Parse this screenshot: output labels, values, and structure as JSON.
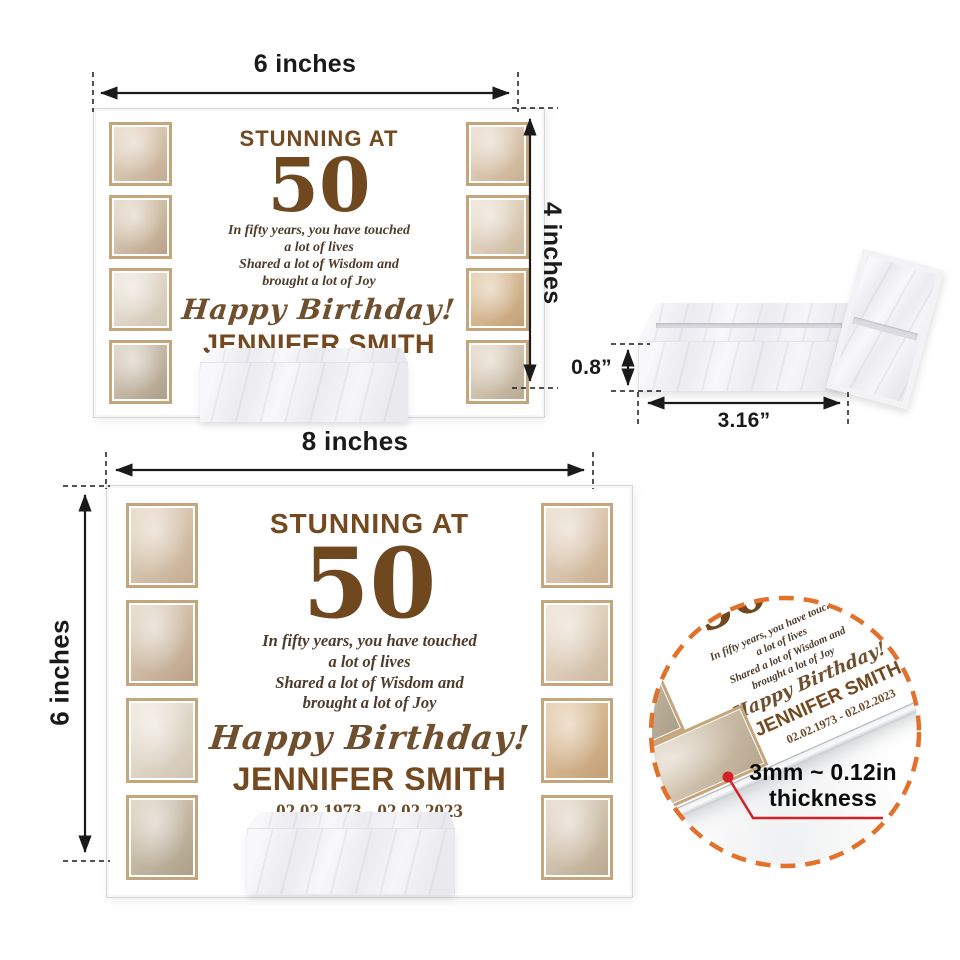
{
  "product_preview": {
    "plaque_text": {
      "title": "STUNNING AT",
      "age": "50",
      "message_lines": [
        "In fifty years, you have touched",
        "a lot of lives",
        "Shared a lot of Wisdom and",
        "brought a lot of Joy"
      ],
      "greeting": "Happy Birthday!",
      "name": "JENNIFER SMITH",
      "dates": "02.02.1973 - 02.02.2023"
    },
    "photos": [
      "three generations with flower bouquet",
      "grandmother and granddaughters looking at phone",
      "mother and children playing in living room",
      "grandmother and child taking selfie on couch",
      "three generations smiling close-up",
      "mother and daughter hugging",
      "family hands joined together",
      "family sitting on couch with phones"
    ],
    "photo_tones": [
      [
        "#e9dbc8",
        "#c2ab90"
      ],
      [
        "#e5d9c9",
        "#b9a084"
      ],
      [
        "#f0e9df",
        "#cfc3b0"
      ],
      [
        "#ddd3c4",
        "#ab9d86"
      ],
      [
        "#ecdfcf",
        "#c8ad8e"
      ],
      [
        "#efe4d6",
        "#cbb79e"
      ],
      [
        "#e7cfae",
        "#c29e74"
      ],
      [
        "#e8dccb",
        "#b7a78f"
      ]
    ],
    "colors": {
      "accent_brown": "#74491f",
      "number_brown": "#6f4820",
      "message_brown": "#4e3b2b",
      "frame_tan": "#c5a67c",
      "circle_orange": "#e2712c",
      "annotation_red": "#d62027",
      "dimension_black": "#1a1a1a"
    }
  },
  "dimensions": {
    "small_plaque_width": "6 inches",
    "small_plaque_height": "4 inches",
    "large_plaque_width": "8 inches",
    "large_plaque_height": "6 inches",
    "base_height": "0.8”",
    "base_width": "3.16”",
    "thickness_line1": "3mm ~ 0.12in",
    "thickness_line2": "thickness"
  }
}
